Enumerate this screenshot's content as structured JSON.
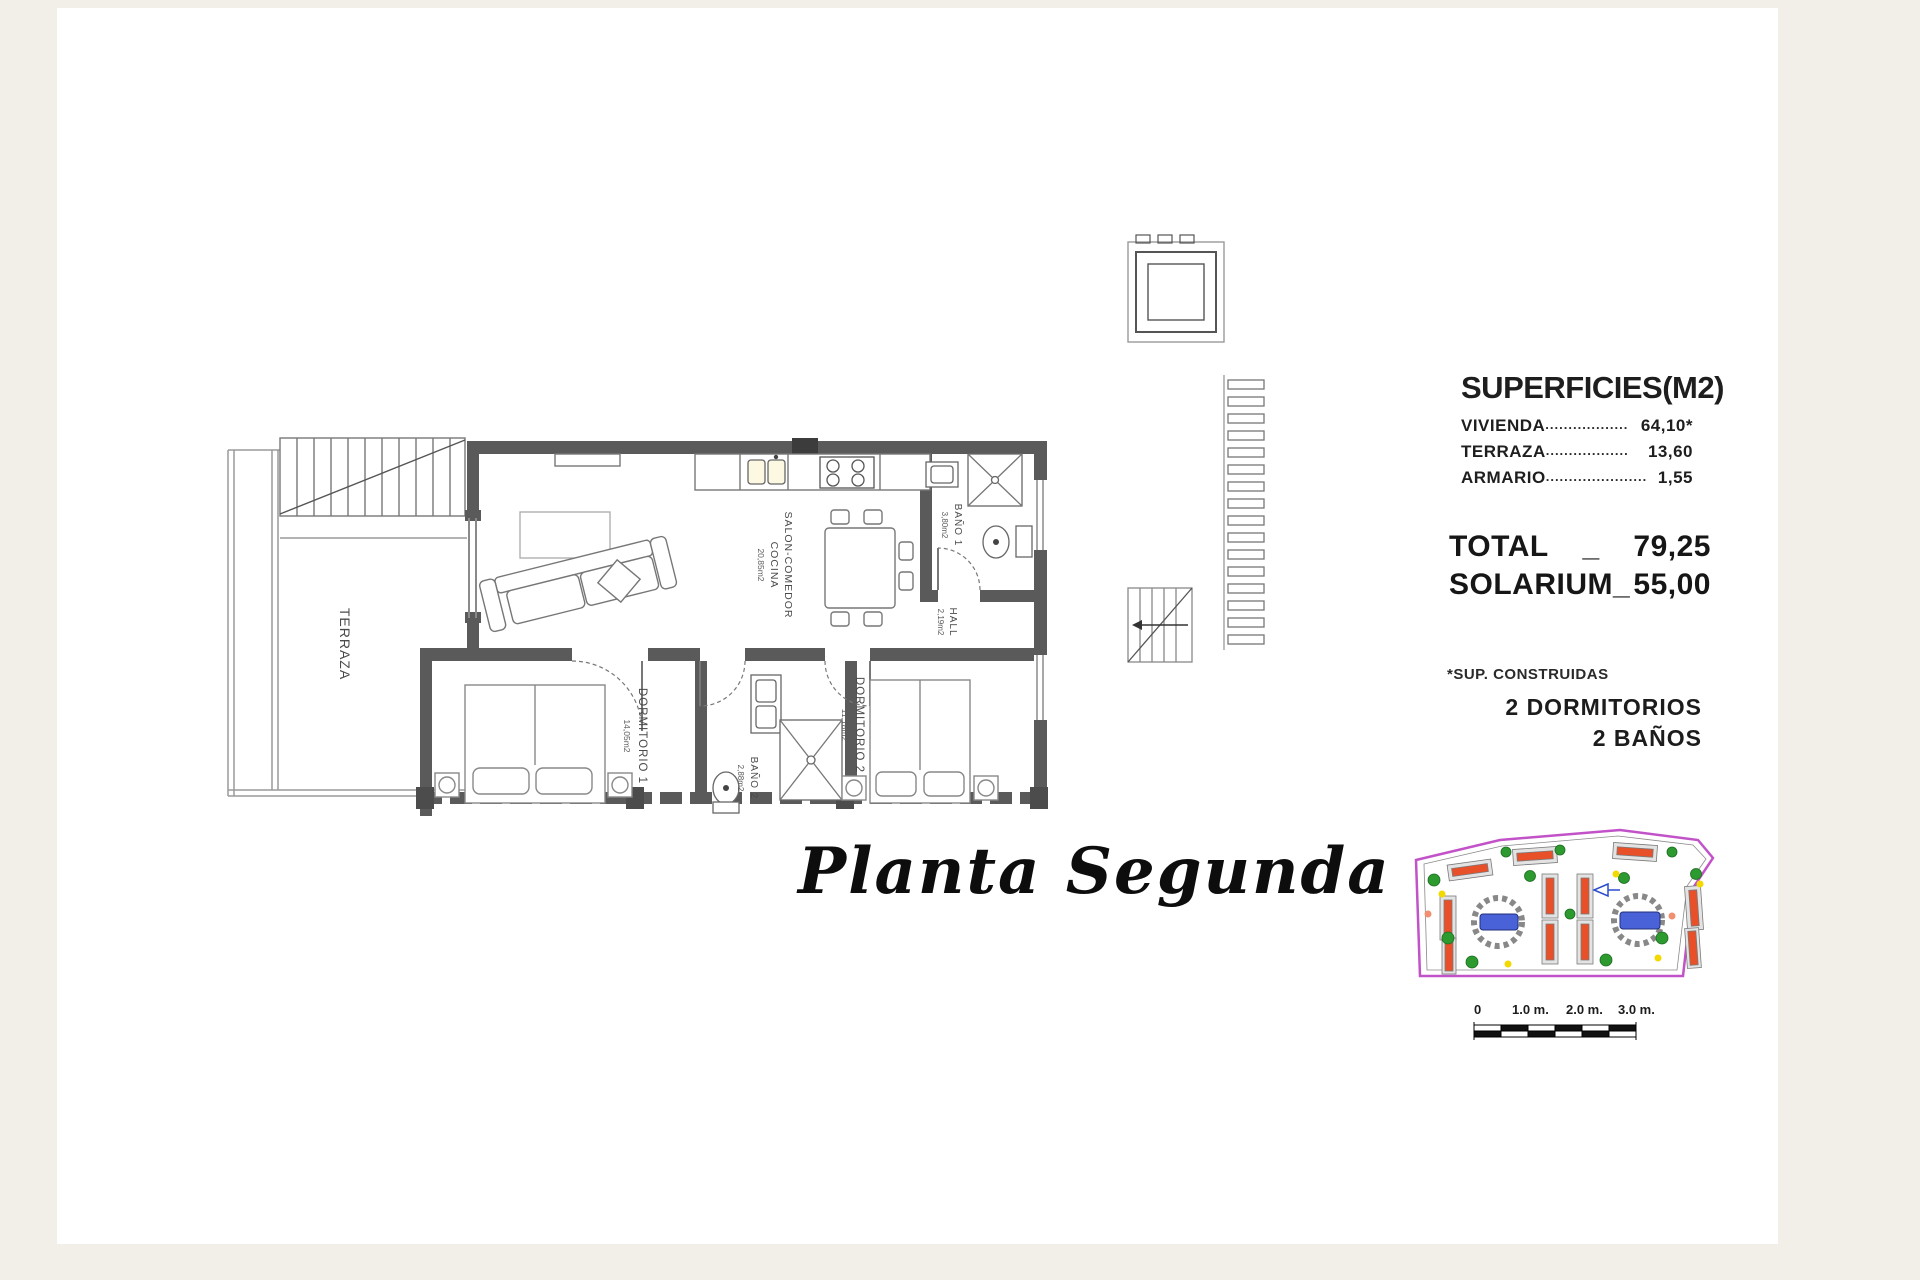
{
  "title": "Planta Segunda",
  "panel": {
    "heading": "SUPERFICIES(M2)",
    "rows": [
      {
        "label": "VIVIENDA",
        "leader": "..................",
        "value": "64,10*"
      },
      {
        "label": "TERRAZA",
        "leader": "..................",
        "value": "13,60"
      },
      {
        "label": "ARMARIO",
        "leader": "......................",
        "value": "1,55"
      }
    ],
    "total": {
      "label": "TOTAL",
      "sep": "_",
      "value": "79,25"
    },
    "solarium": {
      "label": "SOLARIUM_",
      "value": "55,00"
    },
    "footnote": "*SUP. CONSTRUIDAS",
    "features": [
      "2 DORMITORIOS",
      "2 BAÑOS"
    ]
  },
  "rooms": {
    "terraza": {
      "name": "TERRAZA"
    },
    "salon": {
      "name": "SALON-COMEDOR",
      "line2": "COCINA",
      "area": "20,85m2"
    },
    "bano1": {
      "name": "BAÑO 1",
      "area": "3,80m2"
    },
    "hall": {
      "name": "HALL",
      "area": "2,19m2"
    },
    "dorm1": {
      "name": "DORMITORIO 1",
      "area": "14,05m2"
    },
    "bano2": {
      "name": "BAÑO 2",
      "area": "2,88m2"
    },
    "dorm2": {
      "name": "DORMITORIO 2",
      "area": "11,18m2"
    }
  },
  "scale_bar": {
    "labels": [
      "0",
      "1.0 m.",
      "2.0 m.",
      "3.0 m."
    ]
  },
  "colors": {
    "wall_dark": "#5a5a5a",
    "line_gray": "#8a8a8a",
    "site_boundary_magenta": "#c252c8",
    "pool_blue": "#4a62d8",
    "tree_green": "#2c9a2e",
    "roof_red": "#e8502a",
    "dot_yellow": "#f2d900",
    "paper_white": "#ffffff",
    "margin_beige": "#f1efe8"
  }
}
